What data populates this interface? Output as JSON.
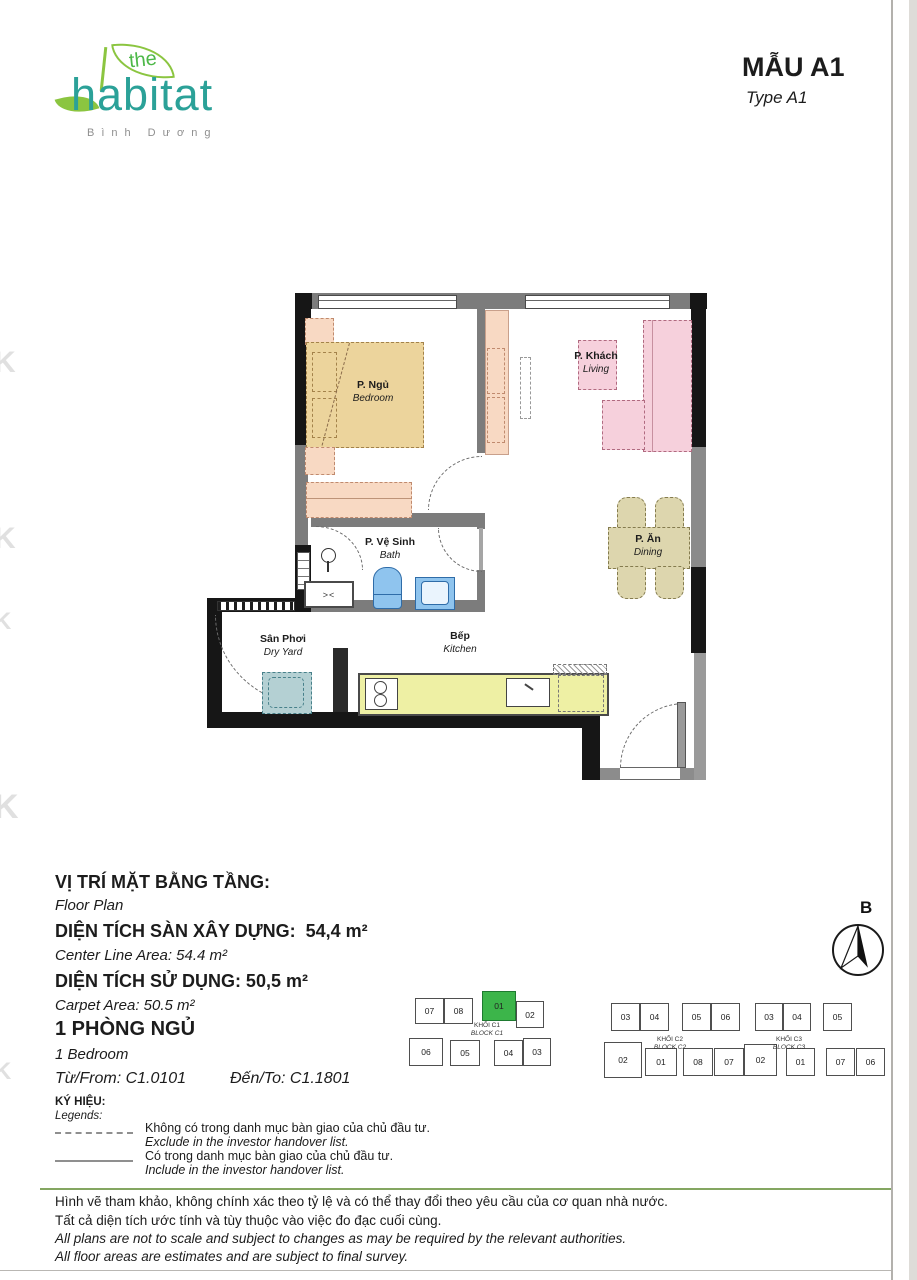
{
  "header": {
    "logo_the": "the",
    "logo_name": "habitat",
    "logo_sub": "Bình Dương",
    "title": "MẪU A1",
    "subtitle": "Type A1"
  },
  "rooms": {
    "bedroom": {
      "vi": "P. Ngủ",
      "en": "Bedroom"
    },
    "living": {
      "vi": "P. Khách",
      "en": "Living"
    },
    "dining": {
      "vi": "P. Ăn",
      "en": "Dining"
    },
    "bath": {
      "vi": "P. Vệ Sinh",
      "en": "Bath"
    },
    "dry_yard": {
      "vi": "Sân Phơi",
      "en": "Dry Yard"
    },
    "kitchen": {
      "vi": "Bếp",
      "en": "Kitchen"
    }
  },
  "plan": {
    "shaft_symbol": "><"
  },
  "info": {
    "rows": [
      {
        "vi": "VỊ TRÍ MẶT BẰNG TẦNG:",
        "en": "Floor Plan"
      },
      {
        "vi": "DIỆN TÍCH SÀN XÂY DỰNG:  54,4 m²",
        "en": "Center Line Area: 54.4 m²"
      },
      {
        "vi": "DIỆN TÍCH SỬ DỤNG: 50,5 m²",
        "en": "Carpet Area: 50.5 m²"
      },
      {
        "vi": "1 PHÒNG NGỦ",
        "en": "1 Bedroom"
      }
    ],
    "from": "Từ/From: C1.0101",
    "to": "Đến/To: C1.1801"
  },
  "legends": {
    "title_vi": "KÝ HIỆU:",
    "title_en": "Legends:",
    "items": [
      {
        "vi": "Không có trong danh mục bàn giao của chủ đầu tư.",
        "en": "Exclude in the investor handover list."
      },
      {
        "vi": "Có trong danh mục bàn giao của chủ đầu tư.",
        "en": "Include in the investor handover list."
      }
    ]
  },
  "compass": {
    "north": "B"
  },
  "blocks": [
    {
      "vi": "KHỐI C1",
      "en": "BLOCK C1",
      "top": [
        "07",
        "08",
        "01",
        "02"
      ],
      "bottom": [
        "06",
        "05",
        "04",
        "03"
      ],
      "highlighted_unit": "01"
    },
    {
      "vi": "KHỐI C2",
      "en": "BLOCK C2",
      "top": [
        "03",
        "04",
        "05",
        "06"
      ],
      "bottom": [
        "02",
        "01",
        "08",
        "07"
      ]
    },
    {
      "vi": "KHỐI C3",
      "en": "BLOCK C3",
      "top": [
        "03",
        "04",
        "05"
      ],
      "bottom": [
        "02",
        "01",
        "07",
        "06"
      ]
    }
  ],
  "disclaimer": {
    "vi": [
      "Hình vẽ tham khảo, không chính xác theo tỷ lệ và có thể thay đổi theo yêu cầu của cơ quan nhà nước.",
      "Tất cả diện tích ước tính và tùy thuộc vào việc đo đạc cuối cùng."
    ],
    "en": [
      "All plans are not to scale and subject to changes as may be required by the relevant authorities.",
      "All floor areas are estimates and are subject to final survey."
    ]
  },
  "watermark": {
    "glyph": "K"
  },
  "colors": {
    "accent_green": "#3cb54a",
    "logo_teal": "#2ba198",
    "logo_leaf": "#8bc540",
    "bed_tan": "#ecd49c",
    "furniture_peach": "#f8d9c3",
    "sofa_pink": "#f6d0dc",
    "dining_tan": "#ddd6ae",
    "kitchen_counter": "#eef0a4",
    "fixture_blue": "#8fc4ee",
    "washer_teal": "#b4d0d3"
  }
}
